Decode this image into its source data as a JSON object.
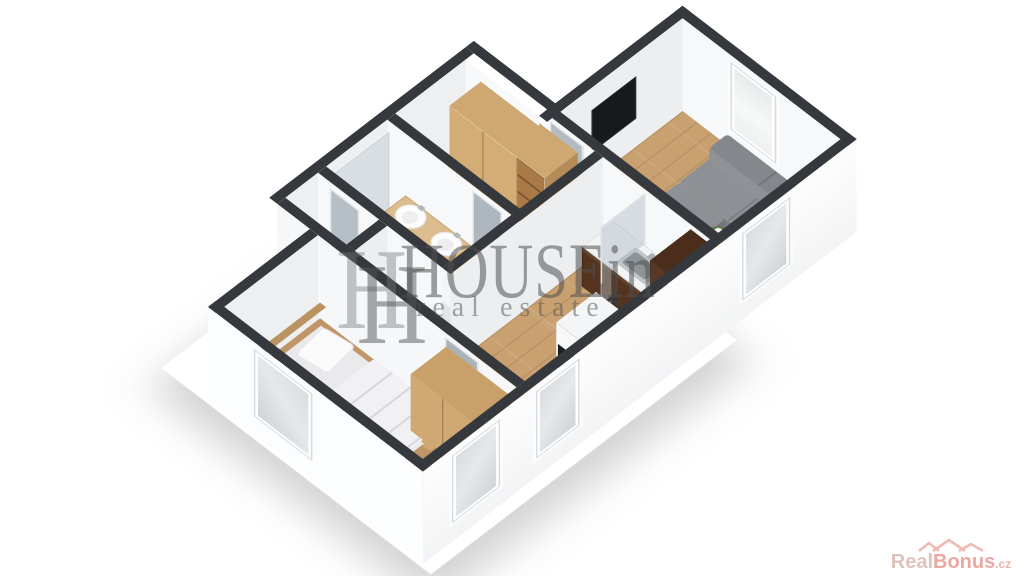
{
  "watermark": {
    "monogram": "H",
    "brand": "HOUSEin",
    "tagline": "real estate"
  },
  "attribution": {
    "brand_first": "Real",
    "brand_second": "Bonus",
    "brand_tld": ".cz"
  },
  "scene": {
    "type": "isometric-3d-floor-plan",
    "rooms": [
      {
        "name": "living-room",
        "floor": "wood",
        "furniture": [
          "corner-sofa",
          "coffee-table",
          "flower-vase",
          "wall-tv",
          "window"
        ]
      },
      {
        "name": "kitchen",
        "floor": "wood",
        "furniture": [
          "kitchen-counter",
          "sink",
          "tall-cabinet",
          "dining-table",
          "chair"
        ]
      },
      {
        "name": "hallway",
        "floor": "wood",
        "furniture": [
          "wardrobe",
          "towel-radiator",
          "interior-door"
        ]
      },
      {
        "name": "corridor",
        "floor": "wood",
        "furniture": [
          "oven-column",
          "potted-plant",
          "window"
        ]
      },
      {
        "name": "bathroom",
        "floor": "tile",
        "furniture": [
          "double-washbasin-vanity",
          "shower-glass",
          "door"
        ]
      },
      {
        "name": "wc",
        "floor": "tile",
        "furniture": [
          "toilet",
          "door"
        ]
      },
      {
        "name": "bedroom",
        "floor": "carpet",
        "furniture": [
          "double-bed",
          "pillows",
          "wardrobe",
          "windows"
        ]
      }
    ]
  },
  "palette": {
    "wall_top": "#35383c",
    "wall_face": "#f7f8f9",
    "wood_floor": "#c9a171",
    "tile_floor": "#e3e5e7",
    "carpet_floor": "#dadad8",
    "sofa_gray": "#8d9095",
    "kitchen_walnut": "#55341f",
    "wood_furniture": "#cfa770",
    "watermark_gray": "#4e5052",
    "logo_pink": "#e89a92"
  }
}
